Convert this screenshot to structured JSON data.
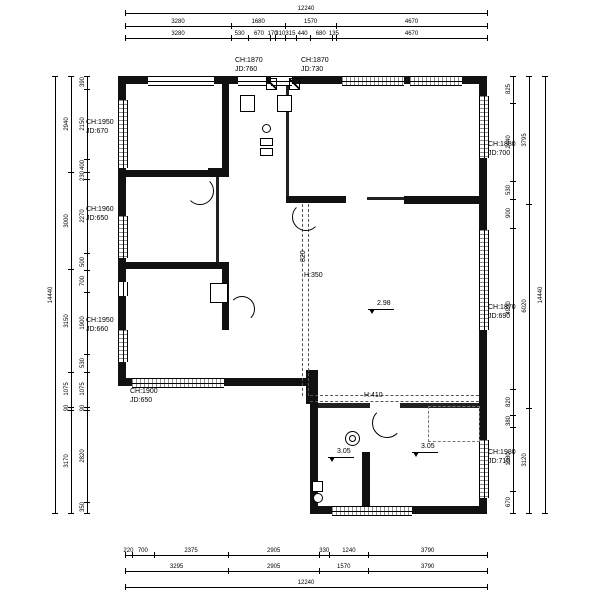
{
  "dims": {
    "top": {
      "total": "12240",
      "row2": [
        "3280",
        "1680",
        "1570",
        "4670"
      ],
      "row3": [
        "3280",
        "530",
        "670",
        "170",
        "310",
        "315",
        "440",
        "680",
        "135",
        "4670"
      ]
    },
    "bottom": {
      "row1": [
        "220",
        "700",
        "2375",
        "2905",
        "330",
        "1240",
        "3790"
      ],
      "row2": [
        "3295",
        "2905",
        "1570",
        "3790"
      ],
      "total": "12240"
    },
    "left": {
      "total": "14440",
      "mid": [
        "2940",
        "3000",
        "3150",
        "1075",
        "90",
        "3170"
      ],
      "inner": [
        "390",
        "2150",
        "400",
        "230",
        "2270",
        "500",
        "700",
        "1900",
        "530",
        "1075",
        "90",
        "2820",
        "350"
      ]
    },
    "right": {
      "total": "14440",
      "mid": [
        "3795",
        "6020",
        "3120"
      ],
      "inner": [
        "825",
        "2440",
        "530",
        "900",
        "4990",
        "820",
        "380",
        "1980",
        "670"
      ]
    }
  },
  "rooms": [
    {
      "ch": "CH:1950",
      "jd": "JD:670"
    },
    {
      "ch": "CH:1870",
      "jd": "JD:760"
    },
    {
      "ch": "CH:1870",
      "jd": "JD:730"
    },
    {
      "ch": "CH:1880",
      "jd": "JD:700"
    },
    {
      "ch": "CH:1960",
      "jd": "JD:650"
    },
    {
      "ch": "CH:1870",
      "jd": "JD:690"
    },
    {
      "ch": "CH:1950",
      "jd": "JD:660"
    },
    {
      "ch": "CH:1900",
      "jd": "JD:650"
    },
    {
      "ch": "CH:1980",
      "jd": "JD:710"
    }
  ],
  "annotations": {
    "beam_height_label": "820",
    "h_350": "H:350",
    "level_living": "2.98",
    "h_410": "H:410",
    "level_bottom_left": "3.05",
    "level_bottom_right": "3.05"
  }
}
